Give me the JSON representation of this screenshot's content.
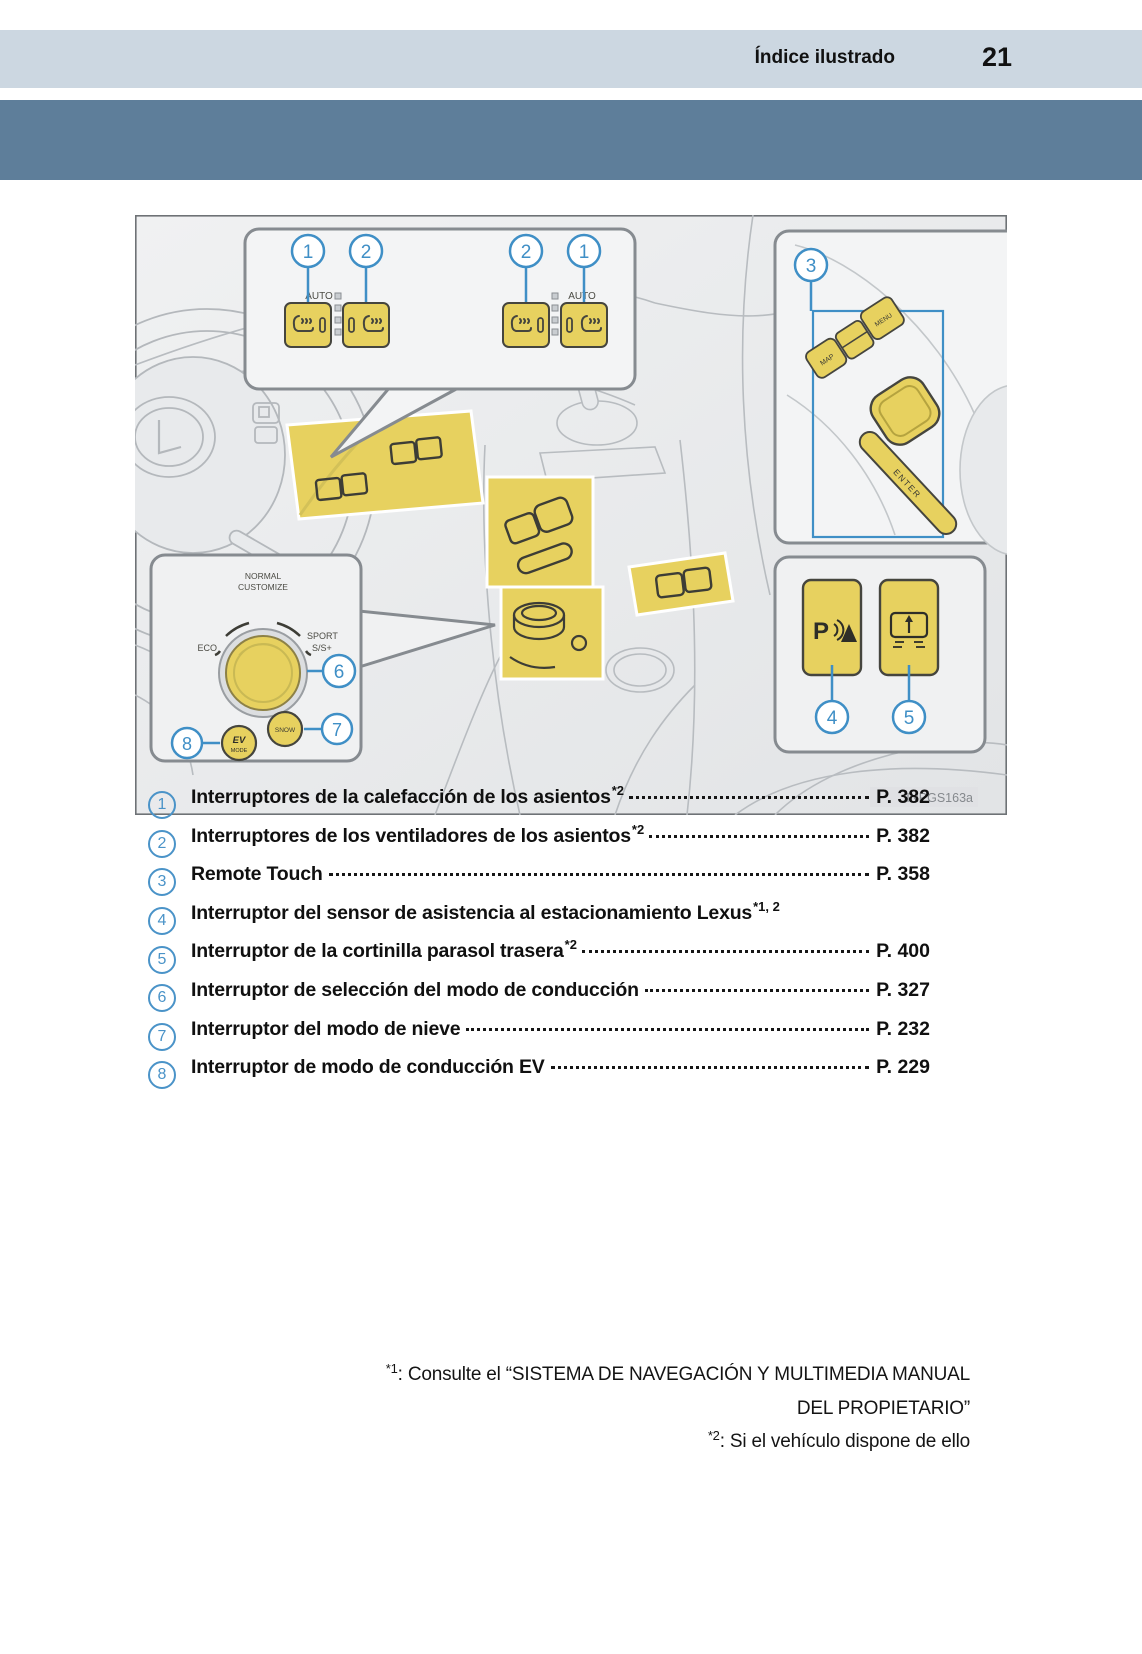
{
  "header": {
    "title": "Índice ilustrado",
    "page_number": "21"
  },
  "illustration": {
    "figure_id": "INPGS163a",
    "callout_numbers": {
      "c1": "1",
      "c2": "2",
      "c2b": "2",
      "c1b": "1",
      "c3": "3",
      "c4": "4",
      "c5": "5",
      "c6": "6",
      "c7": "7",
      "c8": "8"
    },
    "labels": {
      "auto_left": "AUTO",
      "auto_right": "AUTO",
      "normal": "NORMAL",
      "customize": "CUSTOMIZE",
      "eco": "ECO",
      "sport": "SPORT",
      "ssplus": "S/S+",
      "snow": "SNOW",
      "ev": "EV",
      "mode": "MODE",
      "enter": "ENTER",
      "map": "MAP",
      "menu": "MENU",
      "p_sensor": "P"
    },
    "colors": {
      "highlight_yellow": "#e7d15f",
      "callout_blue": "#3f8fc6",
      "band_dark": "#5e7e9a",
      "band_light": "#ccd7e1"
    }
  },
  "index": {
    "items": [
      {
        "num": "1",
        "label": "Interruptores de la calefacción de los asientos",
        "sup": "*2",
        "page": "P. 382"
      },
      {
        "num": "2",
        "label": "Interruptores de los ventiladores de los asientos",
        "sup": "*2",
        "page": "P. 382"
      },
      {
        "num": "3",
        "label": "Remote Touch",
        "sup": "",
        "page": "P. 358"
      },
      {
        "num": "4",
        "label": "Interruptor del sensor de asistencia al estacionamiento Lexus",
        "sup": "*1, 2",
        "page": ""
      },
      {
        "num": "5",
        "label": "Interruptor de la cortinilla parasol trasera",
        "sup": "*2 ",
        "page": "P. 400"
      },
      {
        "num": "6",
        "label": "Interruptor de selección del modo de conducción",
        "sup": "",
        "page": "P. 327"
      },
      {
        "num": "7",
        "label": "Interruptor del modo de nieve ",
        "sup": "",
        "page": "P. 232"
      },
      {
        "num": "8",
        "label": "Interruptor de modo de conducción EV",
        "sup": "",
        "page": "P. 229"
      }
    ]
  },
  "footnotes": [
    {
      "marker": "*1",
      "text": ": Consulte el “SISTEMA DE NAVEGACIÓN Y MULTIMEDIA MANUAL",
      "text2": "DEL PROPIETARIO”"
    },
    {
      "marker": "*2",
      "text": ": Si el vehículo dispone de ello"
    }
  ]
}
